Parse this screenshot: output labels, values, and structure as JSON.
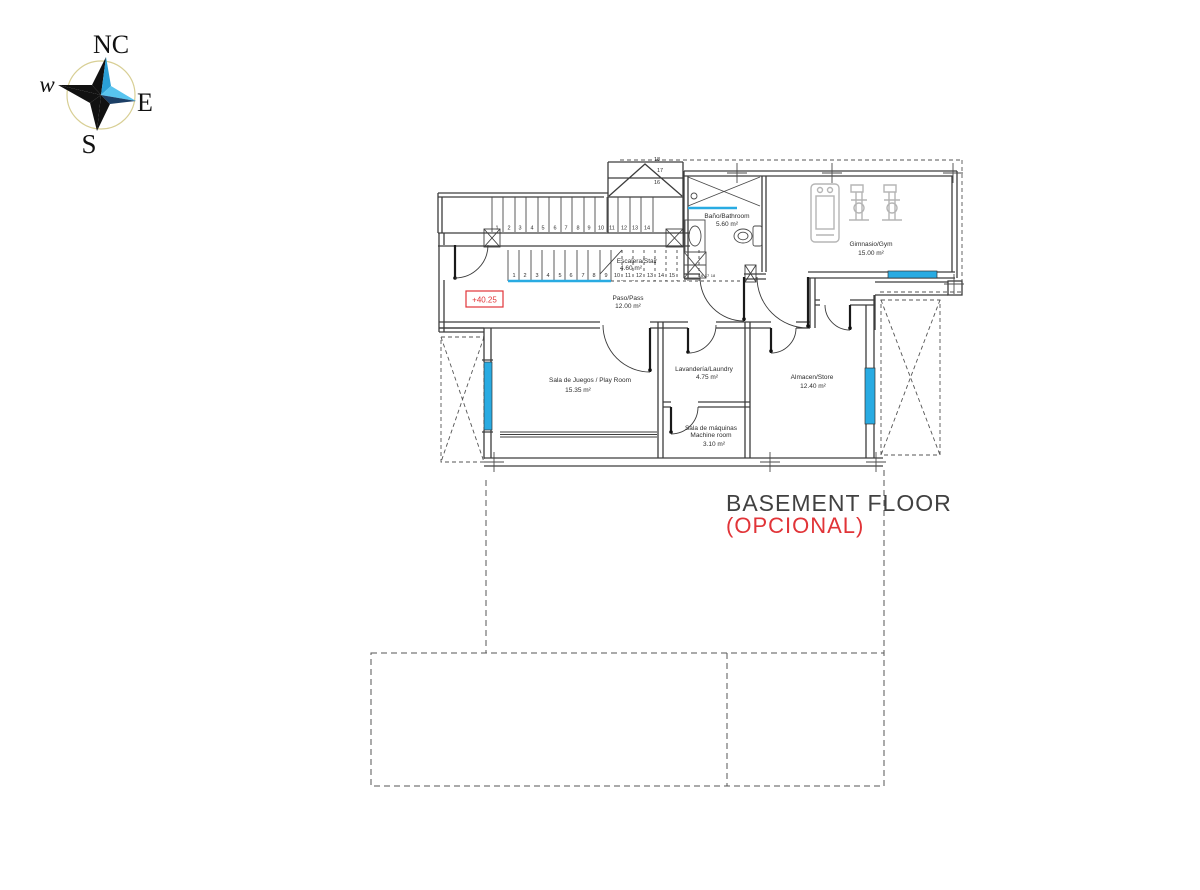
{
  "compass": {
    "north": "NC",
    "west": "w",
    "east": "E",
    "south": "S"
  },
  "level_marker": "+40.25",
  "rooms": {
    "bathroom": {
      "name": "Baño/Bathroom",
      "area": "5.60 m²"
    },
    "gym": {
      "name": "Gimnasio/Gym",
      "area": "15.00 m²"
    },
    "stair": {
      "name": "Escalera/Stair",
      "area": "4.60 m²"
    },
    "hall": {
      "name": "Paso/Pass",
      "area": "12.00 m²"
    },
    "playroom": {
      "name": "Sala de Juegos / Play Room",
      "area": "15.35 m²"
    },
    "laundry": {
      "name": "Lavandería/Laundry",
      "area": "4.75 m²"
    },
    "machine_room": {
      "name": "Sala de máquinas",
      "name_en": "Machine room",
      "area": "3.10 m²"
    },
    "store": {
      "name": "Almacen/Store",
      "area": "12.40 m²"
    }
  },
  "stairs": {
    "upper_run": [
      "1",
      "2",
      "3",
      "4",
      "5",
      "6",
      "7",
      "8",
      "9",
      "10",
      "11",
      "12",
      "13",
      "14"
    ],
    "upper_winders": [
      "18",
      "17",
      "16"
    ],
    "lower_run": [
      "1",
      "2",
      "3",
      "4",
      "5",
      "6",
      "7",
      "8",
      "9",
      "10",
      "11",
      "12",
      "13",
      "14",
      "15"
    ],
    "lower_small": [
      "16",
      "17",
      "18"
    ]
  },
  "title": {
    "line1": "BASEMENT FLOOR",
    "line2": "(OPCIONAL)"
  },
  "colors": {
    "window_blue": "#29abe2",
    "marker_red": "#e13438",
    "wall": "#3d3d3d",
    "equipment_gray": "#b5b5b5",
    "compass_blue": "#2a9fd6",
    "compass_light_blue": "#58c4ef",
    "compass_dark_blue": "#1c3f66",
    "title_gray": "#414141",
    "compass_circle_gold": "#d8cf95"
  }
}
